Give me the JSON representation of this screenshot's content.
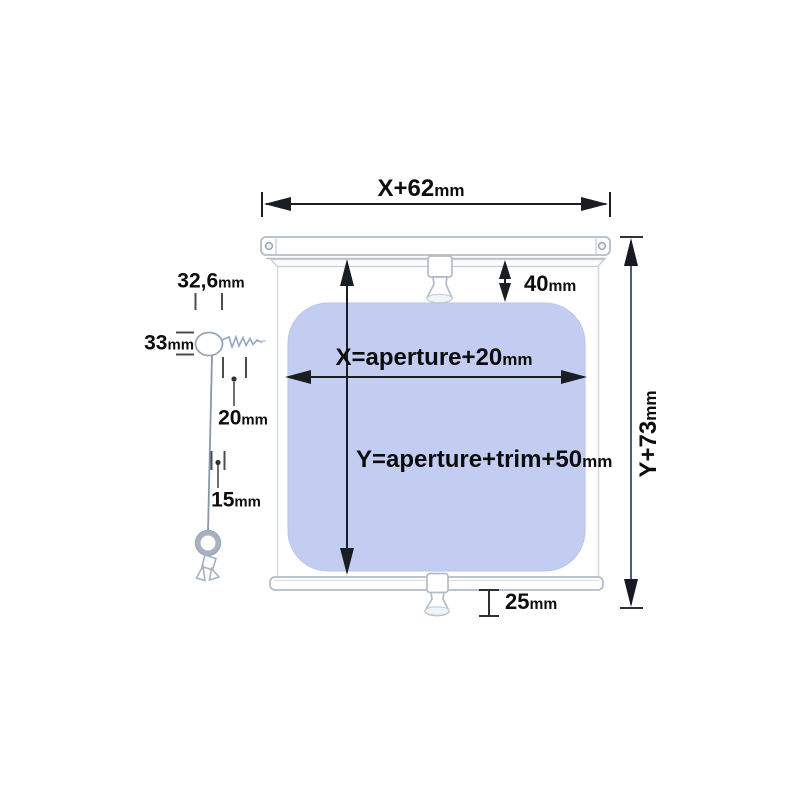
{
  "diagram": {
    "labels": {
      "total_width": {
        "value": "X+62",
        "unit": "mm"
      },
      "headrail_drop": {
        "value": "40",
        "unit": "mm"
      },
      "fabric_width": {
        "value": "X=aperture+20",
        "unit": "mm"
      },
      "fabric_height": {
        "value": "Y=aperture+trim+50",
        "unit": "mm"
      },
      "total_height": {
        "value": "Y+73",
        "unit": "mm"
      },
      "bottom_drop": {
        "value": "25",
        "unit": "mm"
      },
      "screw_eye_width": {
        "value": "32,6",
        "unit": "mm"
      },
      "screw_eye_height": {
        "value": "33",
        "unit": "mm"
      },
      "cord_gap_top": {
        "value": "20",
        "unit": "mm"
      },
      "cord_gap_bottom": {
        "value": "15",
        "unit": "mm"
      }
    },
    "colors": {
      "fabric_fill": "#c3cdf1",
      "hardware_outline": "#b2bcc9",
      "dimension_ink": "#111111",
      "background": "#ffffff"
    }
  }
}
